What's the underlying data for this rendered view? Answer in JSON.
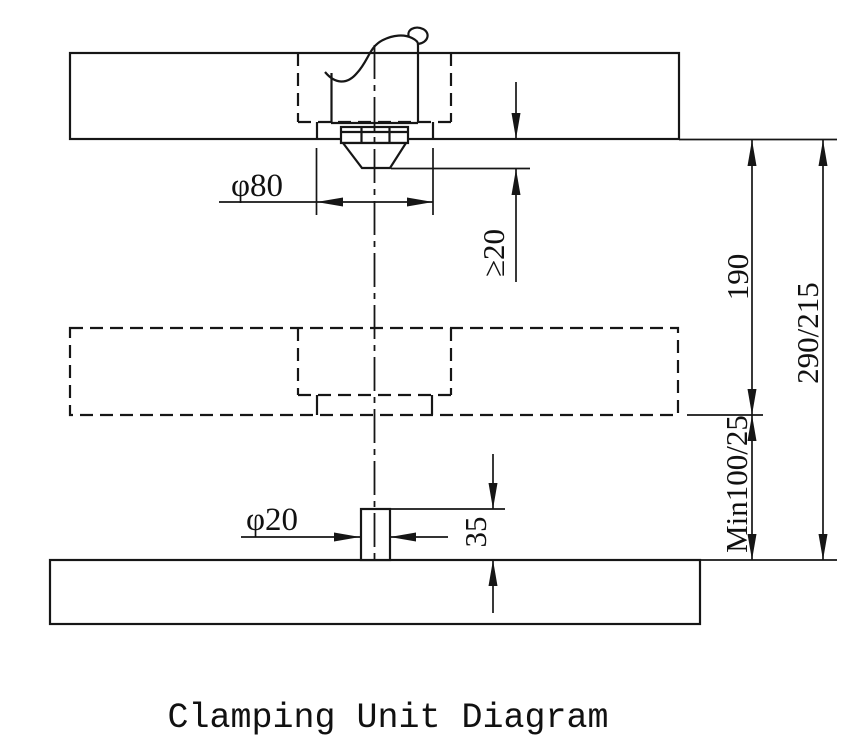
{
  "title": "Clamping Unit Diagram",
  "dimensions": {
    "locating_ring_diameter": "φ80",
    "nozzle_protrusion": "≥20",
    "fixed_to_moving_platen_distance": "190",
    "max_daylight_opening": "290/215",
    "lower_clearance": "Min100/25",
    "ejector_pin_height": "35",
    "ejector_pin_diameter": "φ20"
  },
  "colors": {
    "line": "#161616",
    "background": "#ffffff"
  }
}
